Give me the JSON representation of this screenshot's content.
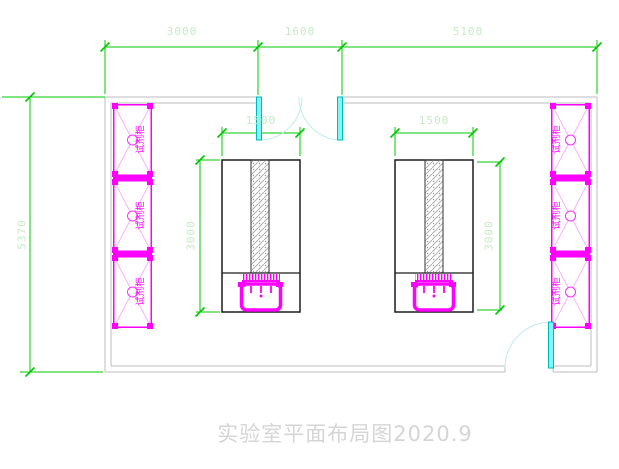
{
  "drawing": {
    "title": "实验室平面布局图2020.9"
  },
  "dimensions": {
    "top": [
      {
        "label": "3000"
      },
      {
        "label": "1600"
      },
      {
        "label": "5100"
      }
    ],
    "left_wall": {
      "label": "5370"
    },
    "bench_left": {
      "width": "1500",
      "depth": "3000"
    },
    "bench_right": {
      "width": "1500",
      "depth": "3000"
    }
  },
  "cabinets": {
    "label": "试剂柜"
  },
  "colors": {
    "dimension_line": "#00c800",
    "dimension_text": "#c6eac6",
    "cabinet": "#ff00ff",
    "door": "#00cccc",
    "wall": "#c9c9c9",
    "bench": "#1c1c1c",
    "title_text": "#d5d5d5"
  }
}
